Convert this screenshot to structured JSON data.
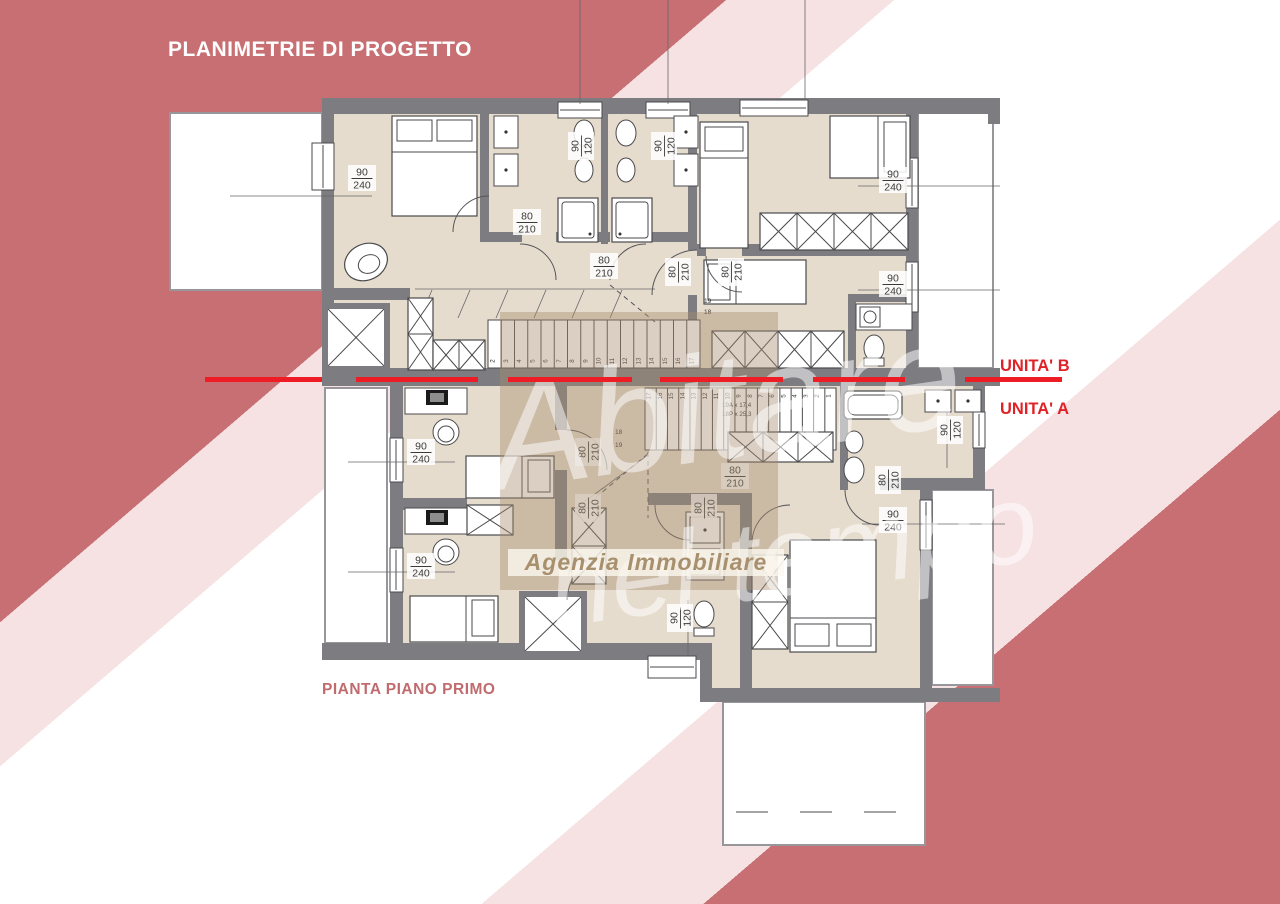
{
  "page_title": "PLANIMETRIE DI PROGETTO",
  "plan_caption": "PIANTA PIANO PRIMO",
  "unit_labels": {
    "unit_b": "UNITA' B",
    "unit_a": "UNITA' A"
  },
  "watermark": {
    "script_line1": "Abitare",
    "script_line2": "nel tempo",
    "agency": "Agenzia Immobiliare"
  },
  "colors": {
    "stripe_rose": "#c76f72",
    "stripe_pink": "#f6e2e3",
    "background_white": "#ffffff",
    "separator_red": "#ee1c25",
    "unit_label_red": "#e02227",
    "caption_rose": "#c06b6e",
    "wall_gray": "#7d7c80",
    "floor_beige": "#e6dccd",
    "watermark_tan": "rgba(167,141,110,0.42)",
    "agency_text_tan": "#a8906f"
  },
  "dimension_labels": [
    {
      "x": 362,
      "y": 178,
      "rot": 0,
      "top": "90",
      "bottom": "240"
    },
    {
      "x": 581,
      "y": 146,
      "rot": 1,
      "top": "90",
      "bottom": "120"
    },
    {
      "x": 664,
      "y": 146,
      "rot": 1,
      "top": "90",
      "bottom": "120"
    },
    {
      "x": 527,
      "y": 222,
      "rot": 0,
      "top": "80",
      "bottom": "210"
    },
    {
      "x": 604,
      "y": 266,
      "rot": 0,
      "top": "80",
      "bottom": "210"
    },
    {
      "x": 678,
      "y": 272,
      "rot": 1,
      "top": "80",
      "bottom": "210"
    },
    {
      "x": 731,
      "y": 272,
      "rot": 1,
      "top": "80",
      "bottom": "210"
    },
    {
      "x": 893,
      "y": 180,
      "rot": 0,
      "top": "90",
      "bottom": "240"
    },
    {
      "x": 893,
      "y": 284,
      "rot": 0,
      "top": "90",
      "bottom": "240"
    },
    {
      "x": 421,
      "y": 452,
      "rot": 0,
      "top": "90",
      "bottom": "240"
    },
    {
      "x": 421,
      "y": 566,
      "rot": 0,
      "top": "90",
      "bottom": "240"
    },
    {
      "x": 588,
      "y": 452,
      "rot": 1,
      "top": "80",
      "bottom": "210"
    },
    {
      "x": 588,
      "y": 508,
      "rot": 1,
      "top": "80",
      "bottom": "210"
    },
    {
      "x": 704,
      "y": 508,
      "rot": 1,
      "top": "80",
      "bottom": "210"
    },
    {
      "x": 735,
      "y": 476,
      "rot": 0,
      "top": "80",
      "bottom": "210"
    },
    {
      "x": 950,
      "y": 430,
      "rot": 1,
      "top": "90",
      "bottom": "120"
    },
    {
      "x": 888,
      "y": 480,
      "rot": 1,
      "top": "80",
      "bottom": "210"
    },
    {
      "x": 893,
      "y": 520,
      "rot": 0,
      "top": "90",
      "bottom": "240"
    },
    {
      "x": 680,
      "y": 618,
      "rot": 1,
      "top": "90",
      "bottom": "120"
    }
  ],
  "stairs": {
    "unit_b_steps": [
      "2",
      "3",
      "4",
      "5",
      "6",
      "7",
      "8",
      "9",
      "10",
      "11",
      "12",
      "13",
      "14",
      "15",
      "16",
      "17"
    ],
    "unit_b_extra": [
      "19",
      "18"
    ],
    "unit_a_steps": [
      "17",
      "16",
      "15",
      "14",
      "13",
      "12",
      "11",
      "10",
      "9",
      "8",
      "7",
      "6",
      "5",
      "4",
      "3",
      "2",
      "1"
    ],
    "unit_a_extra": [
      "18",
      "19"
    ],
    "tread_note_line1": "19A x 17,4",
    "tread_note_line2": "18P x 25,3"
  }
}
